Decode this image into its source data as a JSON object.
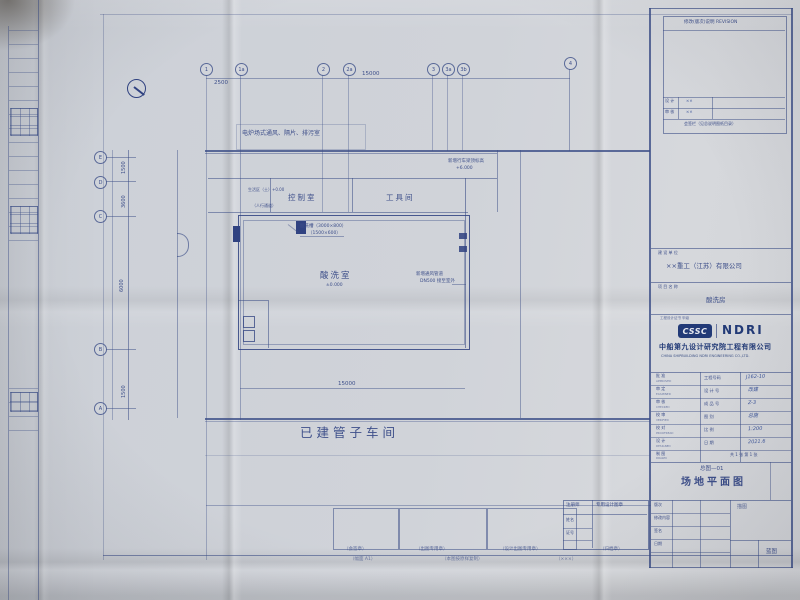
{
  "colors": {
    "paper": "#ccd0d7",
    "ink": "#3c4f8f",
    "ink_dark": "#2e4286",
    "navy": "#203a7c"
  },
  "top_right_table": {
    "header": "修改(版次)说明 REVISION",
    "rows": [
      {
        "label": "设 计",
        "value": "××"
      },
      {
        "label": "审 核",
        "value": "××"
      }
    ],
    "footer": "会签栏（见总说明图纸目录）"
  },
  "owner": {
    "label": "建 设 单 位",
    "value": "××重工（江苏）有限公司"
  },
  "project": {
    "label": "项 目 名 称",
    "value": "酸洗房"
  },
  "cert": {
    "text": "工程设计证书 甲级"
  },
  "logo": {
    "badge": "CSSC",
    "brand": "NDRI",
    "company_cn": "中船第九设计研究院工程有限公司",
    "company_en": "CHINA SHIPBUILDING NDRI ENGINEERING CO.,LTD."
  },
  "sign_table": {
    "left_rows": [
      {
        "cn": "批 准",
        "en": "APPROVED"
      },
      {
        "cn": "审 定",
        "en": "EXAMINED"
      },
      {
        "cn": "审 核",
        "en": "CHECKED"
      },
      {
        "cn": "校 审",
        "en": "VERIFIED"
      },
      {
        "cn": "校 对",
        "en": "PROOFREAD"
      },
      {
        "cn": "设 计",
        "en": "DESIGNED"
      },
      {
        "cn": "制 图",
        "en": "DRAWN"
      }
    ],
    "fields": [
      {
        "label": "工程号码",
        "value": "J162-10"
      },
      {
        "label": "设 计 号",
        "value": "改建"
      },
      {
        "label": "成 品 号",
        "value": "Z-3"
      },
      {
        "label": "图  别",
        "value": "总施"
      },
      {
        "label": "比  例",
        "value": "1:200"
      },
      {
        "label": "日  期",
        "value": "2021.6"
      }
    ],
    "sheet_note": "共 1 张 第 1 张"
  },
  "title_box": {
    "sub": "总图—01",
    "main": "场地平面图"
  },
  "bottom_left_table": {
    "rows": [
      "版次",
      "修改内容",
      "签名",
      "日期"
    ]
  },
  "corner_cells": {
    "upper": "描图",
    "lower": "蓝图"
  },
  "stamp_table": {
    "h1": "注册师",
    "h2": "专用设计图章",
    "r1": "姓名",
    "r2": "证号"
  },
  "bottom_captions": [
    "（会签章）",
    "（出图专用章）",
    "（设计出图专用章）",
    "（归档章）"
  ],
  "edge_captions": [
    "（幅面 A1）",
    "（本图按原样复制）",
    "（×××）"
  ],
  "plan": {
    "top_note": "电炉场式通风、隔片、排污室",
    "crane_note_1": "新增行车梁顶标高",
    "crane_note_2": "+6.000",
    "right_note_1": "新增通风管道",
    "right_note_2": "DN500 接至室外",
    "tank_note_1": "酸洗槽（3000×800）",
    "tank_note_2": "（1500×600）",
    "room_control": "控制室",
    "room_tool": "工具间",
    "room_main": "酸洗室",
    "room_main_elev": "±0.000",
    "existing": "已建管子车间",
    "note_small_1": "生活区（土）+0.00",
    "note_small_2": "（人行通道）",
    "grid_top": [
      "1",
      "1a",
      "2",
      "2a",
      "3",
      "3a",
      "3b",
      "4"
    ],
    "grid_left": [
      "E",
      "D",
      "C",
      "B",
      "A"
    ],
    "dim_top_1": "2500",
    "dim_top_2": "15000",
    "dim_bottom": "15000",
    "dims_left": [
      "1500",
      "3600",
      "6000",
      "1500"
    ]
  }
}
